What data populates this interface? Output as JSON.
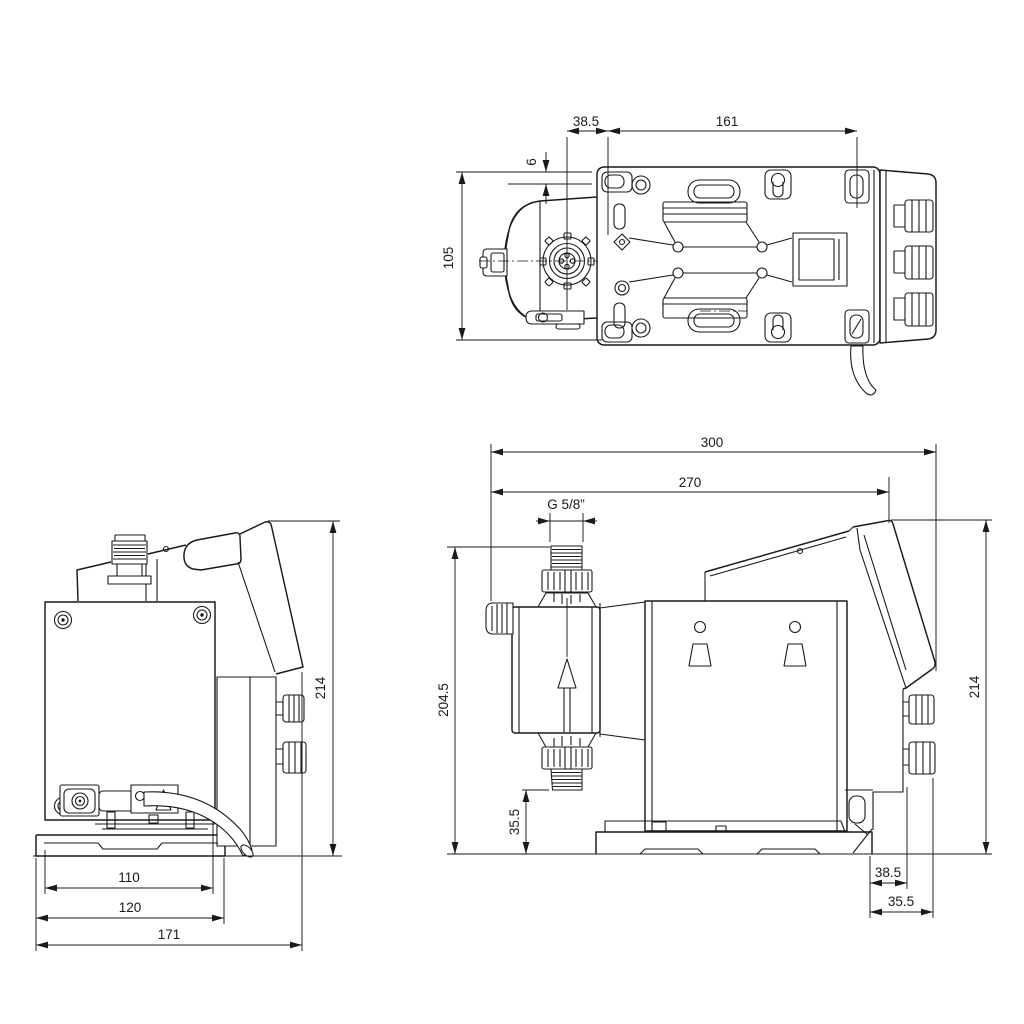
{
  "colors": {
    "line": "#1a1a1a",
    "background": "#ffffff"
  },
  "views": {
    "top": {
      "dims": {
        "flange_offset": "38.5",
        "mounting_holes": "161",
        "edge_offset": "6",
        "depth": "105"
      }
    },
    "rear": {
      "dims": {
        "height": "214",
        "foot_inner_width": "110",
        "foot_outer_width": "120",
        "overall_width": "171"
      }
    },
    "side": {
      "dims": {
        "overall_length": "300",
        "front_to_rear_panel": "270",
        "thread": "G 5/8”",
        "inlet_height": "204.5",
        "outlet_height": "35.5",
        "height": "214",
        "rear_offset": "38.5",
        "rear_clearance": "35.5"
      }
    }
  }
}
